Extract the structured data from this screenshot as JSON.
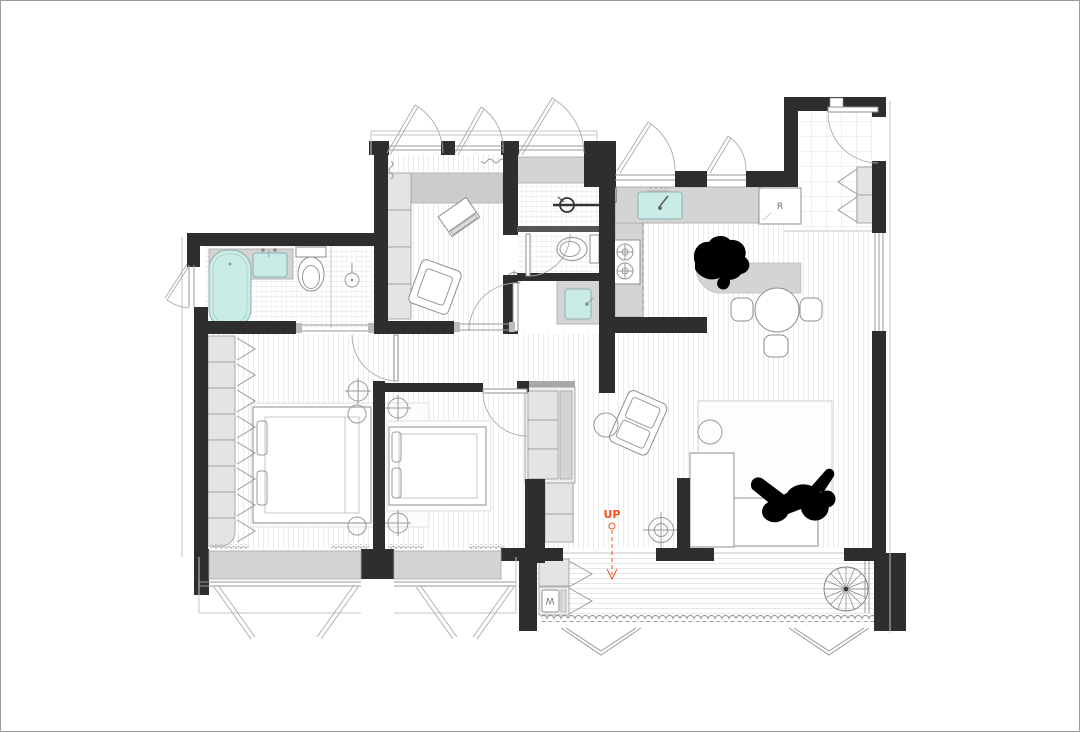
{
  "plan": {
    "labels": {
      "stairs_up": "UP",
      "refrigerator": "R",
      "washer": "W"
    },
    "colors": {
      "wall": "#2e2e2e",
      "fixture": "#c9ece7",
      "accent": "#f4511e",
      "furniture": "#e2e2e2",
      "counter": "#d4d4d4",
      "silhouette": "#000000",
      "background": "#ffffff"
    }
  }
}
